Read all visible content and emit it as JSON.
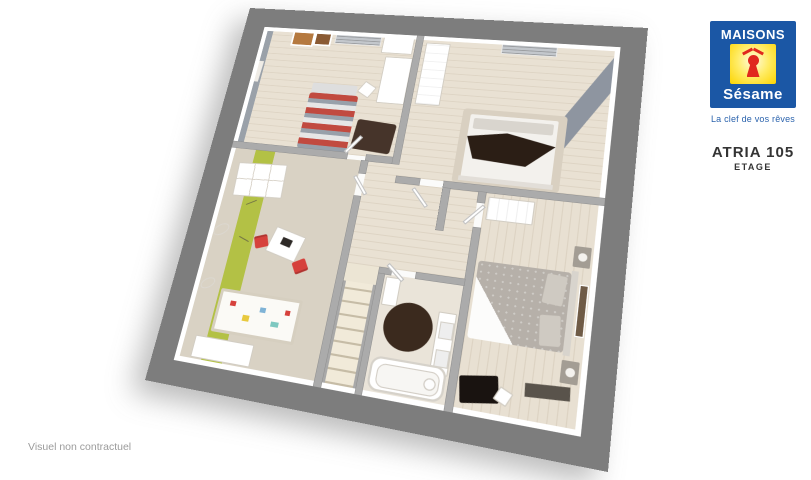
{
  "branding": {
    "logo_top": "MAISONS",
    "logo_bottom": "Sésame",
    "tagline": "La clef de vos rêves",
    "model": "ATRIA 105",
    "floor_label": "ETAGE",
    "colors": {
      "blue": "#1b57a5",
      "yellow": "#fcd400",
      "red": "#e0281e"
    }
  },
  "footer": {
    "disclaimer": "Visuel non contractuel"
  },
  "floorplan": {
    "type": "3d-floor-plan",
    "rooms": [
      "bedroom-striped-bed",
      "bedroom-dark-throw-bed",
      "kids-bedroom-green-stripe",
      "landing-with-stairs",
      "bathroom",
      "master-bedroom"
    ],
    "colors": {
      "outer_wall_gray": "#7d7d7d",
      "wood_floor": "#e9e1d3",
      "carpet": "#d9d2c4",
      "accent_green_stripe": "#b3c145",
      "kids_chair_red": "#d6413c",
      "bed_stripe_red": "#c14a40",
      "dark_rug_brown": "#3b2a1e",
      "master_duvet_gray": "#b6b0a9",
      "accent_wall_gray": "#9aa1a9"
    }
  }
}
